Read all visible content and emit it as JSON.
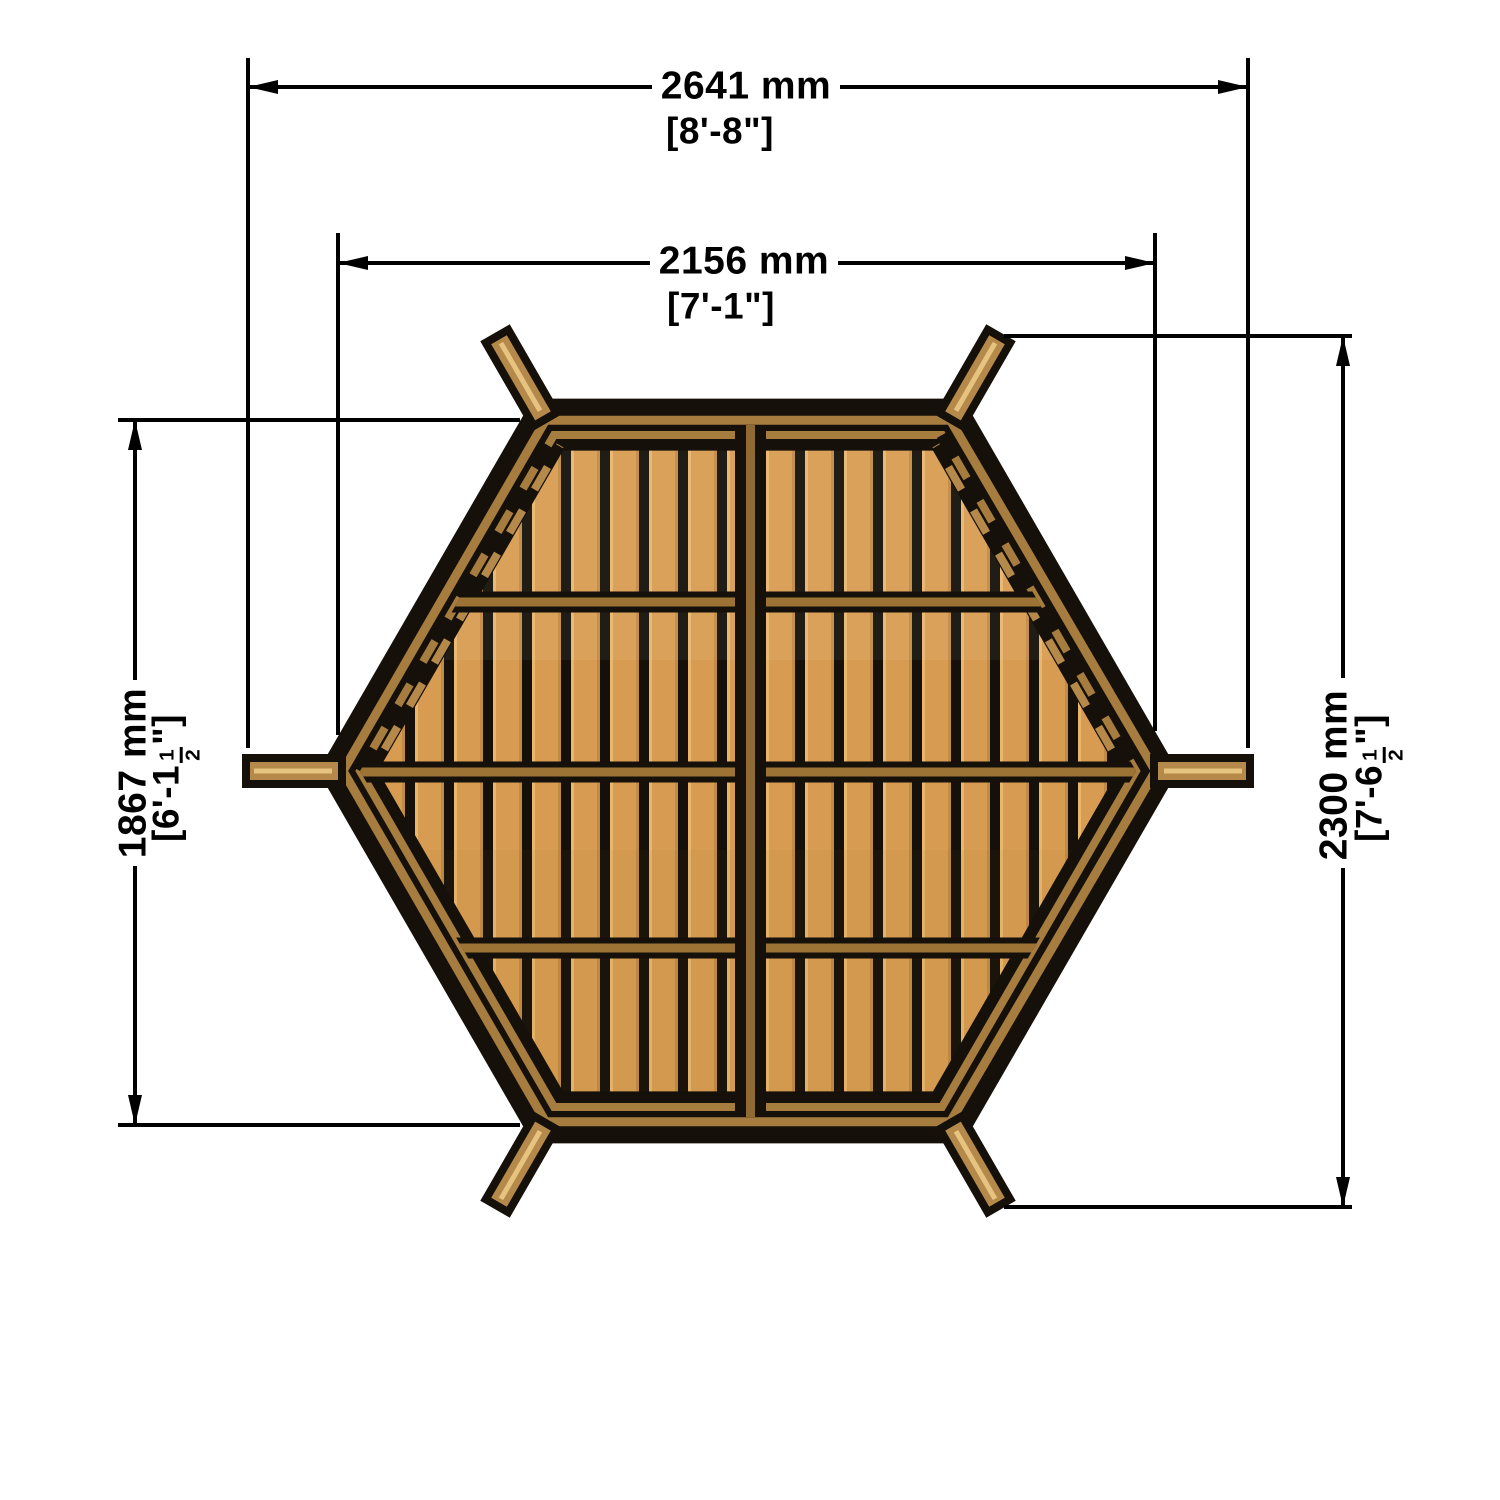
{
  "drawing": {
    "type": "hexagonal-gazebo-floor-plan-top-view",
    "background": "#ffffff",
    "colors": {
      "outline_black": "#15100a",
      "plank_wood": "#d79c52",
      "plank_highlight": "#e9b66c",
      "rim_wood": "#a67d3e",
      "beam_wood": "#8f6a33",
      "rafter_wood": "#b5894a",
      "rafter_highlight": "#e6c47f",
      "dimension_line": "#000000"
    }
  },
  "dimensions": {
    "top_outer": {
      "metric": "2641 mm",
      "imperial": "[8'-8\"]"
    },
    "top_inner": {
      "metric": "2156 mm",
      "imperial": "[7'-1\"]"
    },
    "left": {
      "metric": "1867 mm",
      "imperial_prefix": "[6'-1",
      "fraction_numerator": "1",
      "fraction_denominator": "2",
      "imperial_suffix": "\"]"
    },
    "right": {
      "metric": "2300 mm",
      "imperial_prefix": "[7'-6",
      "fraction_numerator": "1",
      "fraction_denominator": "2",
      "imperial_suffix": "\"]"
    }
  }
}
